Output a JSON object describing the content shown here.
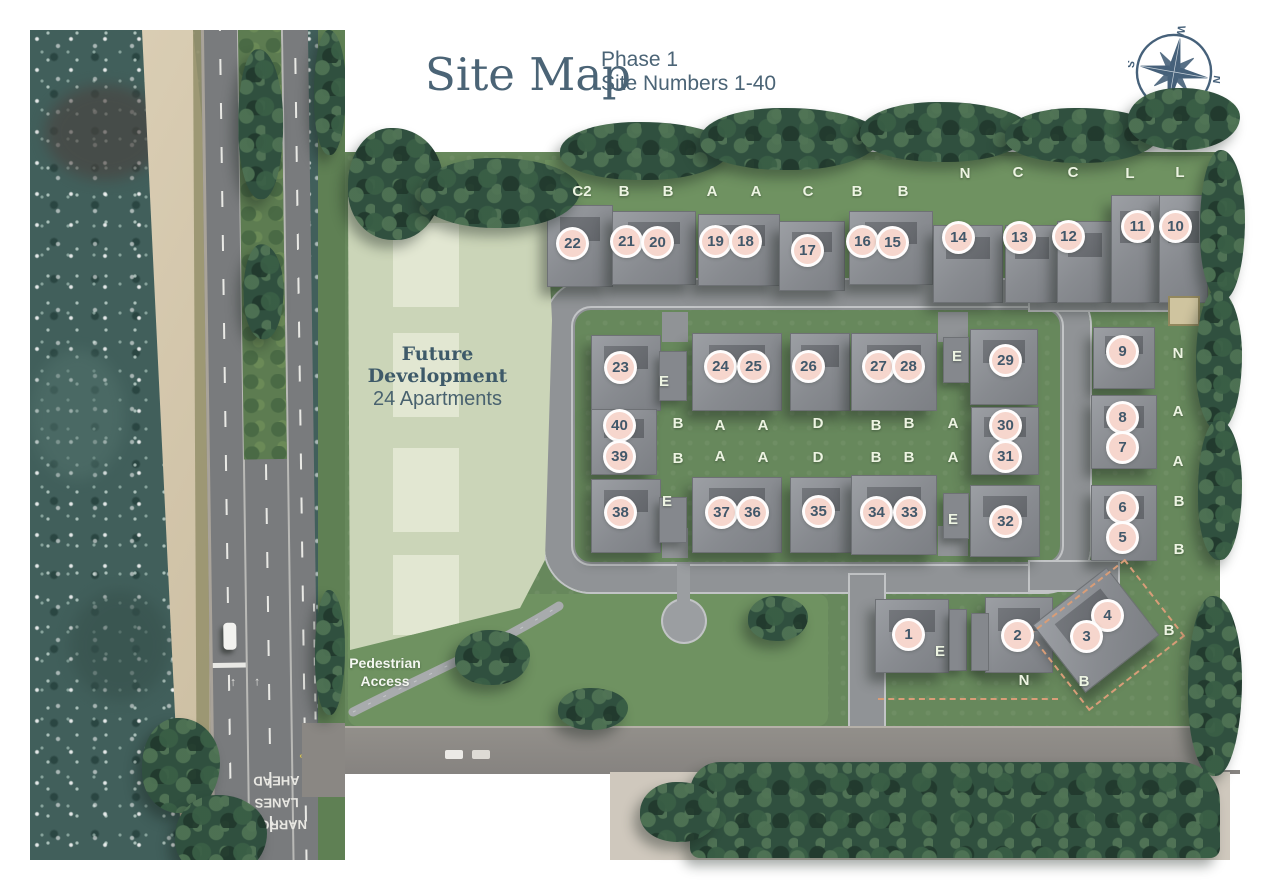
{
  "header": {
    "title": "Site Map",
    "phase": "Phase 1",
    "subtitle": "Site Numbers 1-40"
  },
  "compass": {
    "n": "N",
    "s": "S",
    "e": "E",
    "w": "W",
    "rotation_deg": 100
  },
  "future_development": {
    "line1": "Future",
    "line2": "Development",
    "line3": "24 Apartments"
  },
  "labels": {
    "pedestrian_access": "Pedestrian\nAccess"
  },
  "road_markings": {
    "narrow_lanes": "NARROW\nLANES\nAHEAD",
    "bus_stop": "BUS\nSTOP"
  },
  "colors": {
    "brand_slate": "#4b6476",
    "marker_fill": "#f6d6cd",
    "marker_text": "#42586a",
    "site_grass": "#67885c",
    "future_sage": "#cbd5b8",
    "road_gray": "#909396",
    "tree_green": "#30503f",
    "water_teal": "#415f5b"
  },
  "site": {
    "plots": [
      {
        "num": "22",
        "x": 573,
        "y": 244
      },
      {
        "num": "21",
        "x": 627,
        "y": 242
      },
      {
        "num": "20",
        "x": 658,
        "y": 243
      },
      {
        "num": "19",
        "x": 716,
        "y": 242
      },
      {
        "num": "18",
        "x": 746,
        "y": 242
      },
      {
        "num": "17",
        "x": 808,
        "y": 251
      },
      {
        "num": "16",
        "x": 863,
        "y": 242
      },
      {
        "num": "15",
        "x": 893,
        "y": 243
      },
      {
        "num": "14",
        "x": 959,
        "y": 238
      },
      {
        "num": "13",
        "x": 1020,
        "y": 238
      },
      {
        "num": "12",
        "x": 1069,
        "y": 237
      },
      {
        "num": "11",
        "x": 1138,
        "y": 227
      },
      {
        "num": "10",
        "x": 1176,
        "y": 227
      },
      {
        "num": "23",
        "x": 621,
        "y": 368
      },
      {
        "num": "24",
        "x": 721,
        "y": 367
      },
      {
        "num": "25",
        "x": 754,
        "y": 367
      },
      {
        "num": "26",
        "x": 809,
        "y": 367
      },
      {
        "num": "27",
        "x": 879,
        "y": 367
      },
      {
        "num": "28",
        "x": 909,
        "y": 367
      },
      {
        "num": "29",
        "x": 1006,
        "y": 361
      },
      {
        "num": "40",
        "x": 620,
        "y": 426
      },
      {
        "num": "39",
        "x": 620,
        "y": 457
      },
      {
        "num": "30",
        "x": 1006,
        "y": 426
      },
      {
        "num": "31",
        "x": 1006,
        "y": 457
      },
      {
        "num": "38",
        "x": 621,
        "y": 513
      },
      {
        "num": "37",
        "x": 722,
        "y": 513
      },
      {
        "num": "36",
        "x": 753,
        "y": 513
      },
      {
        "num": "35",
        "x": 819,
        "y": 512
      },
      {
        "num": "34",
        "x": 877,
        "y": 513
      },
      {
        "num": "33",
        "x": 910,
        "y": 513
      },
      {
        "num": "32",
        "x": 1006,
        "y": 522
      },
      {
        "num": "9",
        "x": 1123,
        "y": 352
      },
      {
        "num": "8",
        "x": 1123,
        "y": 418
      },
      {
        "num": "7",
        "x": 1123,
        "y": 448
      },
      {
        "num": "6",
        "x": 1123,
        "y": 508
      },
      {
        "num": "5",
        "x": 1123,
        "y": 538
      },
      {
        "num": "4",
        "x": 1108,
        "y": 616
      },
      {
        "num": "3",
        "x": 1087,
        "y": 637
      },
      {
        "num": "2",
        "x": 1018,
        "y": 636
      },
      {
        "num": "1",
        "x": 909,
        "y": 635
      }
    ],
    "house_types": [
      {
        "t": "C2",
        "x": 582,
        "y": 193
      },
      {
        "t": "B",
        "x": 624,
        "y": 193
      },
      {
        "t": "B",
        "x": 668,
        "y": 193
      },
      {
        "t": "A",
        "x": 712,
        "y": 193
      },
      {
        "t": "A",
        "x": 756,
        "y": 193
      },
      {
        "t": "C",
        "x": 808,
        "y": 193
      },
      {
        "t": "B",
        "x": 857,
        "y": 193
      },
      {
        "t": "B",
        "x": 903,
        "y": 193
      },
      {
        "t": "N",
        "x": 965,
        "y": 175
      },
      {
        "t": "C",
        "x": 1018,
        "y": 174
      },
      {
        "t": "C",
        "x": 1073,
        "y": 174
      },
      {
        "t": "L",
        "x": 1130,
        "y": 175
      },
      {
        "t": "L",
        "x": 1180,
        "y": 174
      },
      {
        "t": "E",
        "x": 664,
        "y": 383
      },
      {
        "t": "E",
        "x": 957,
        "y": 358
      },
      {
        "t": "E",
        "x": 667,
        "y": 503
      },
      {
        "t": "E",
        "x": 953,
        "y": 521
      },
      {
        "t": "B",
        "x": 678,
        "y": 425
      },
      {
        "t": "A",
        "x": 720,
        "y": 427
      },
      {
        "t": "A",
        "x": 763,
        "y": 427
      },
      {
        "t": "D",
        "x": 818,
        "y": 425
      },
      {
        "t": "B",
        "x": 876,
        "y": 427
      },
      {
        "t": "B",
        "x": 909,
        "y": 425
      },
      {
        "t": "A",
        "x": 953,
        "y": 425
      },
      {
        "t": "B",
        "x": 678,
        "y": 460
      },
      {
        "t": "A",
        "x": 720,
        "y": 458
      },
      {
        "t": "A",
        "x": 763,
        "y": 459
      },
      {
        "t": "D",
        "x": 818,
        "y": 459
      },
      {
        "t": "B",
        "x": 876,
        "y": 459
      },
      {
        "t": "B",
        "x": 909,
        "y": 459
      },
      {
        "t": "A",
        "x": 953,
        "y": 459
      },
      {
        "t": "N",
        "x": 1178,
        "y": 355
      },
      {
        "t": "A",
        "x": 1178,
        "y": 413
      },
      {
        "t": "A",
        "x": 1178,
        "y": 463
      },
      {
        "t": "B",
        "x": 1179,
        "y": 503
      },
      {
        "t": "B",
        "x": 1179,
        "y": 551
      },
      {
        "t": "E",
        "x": 940,
        "y": 653
      },
      {
        "t": "N",
        "x": 1024,
        "y": 682
      },
      {
        "t": "B",
        "x": 1084,
        "y": 683
      },
      {
        "t": "B",
        "x": 1169,
        "y": 632
      }
    ]
  }
}
